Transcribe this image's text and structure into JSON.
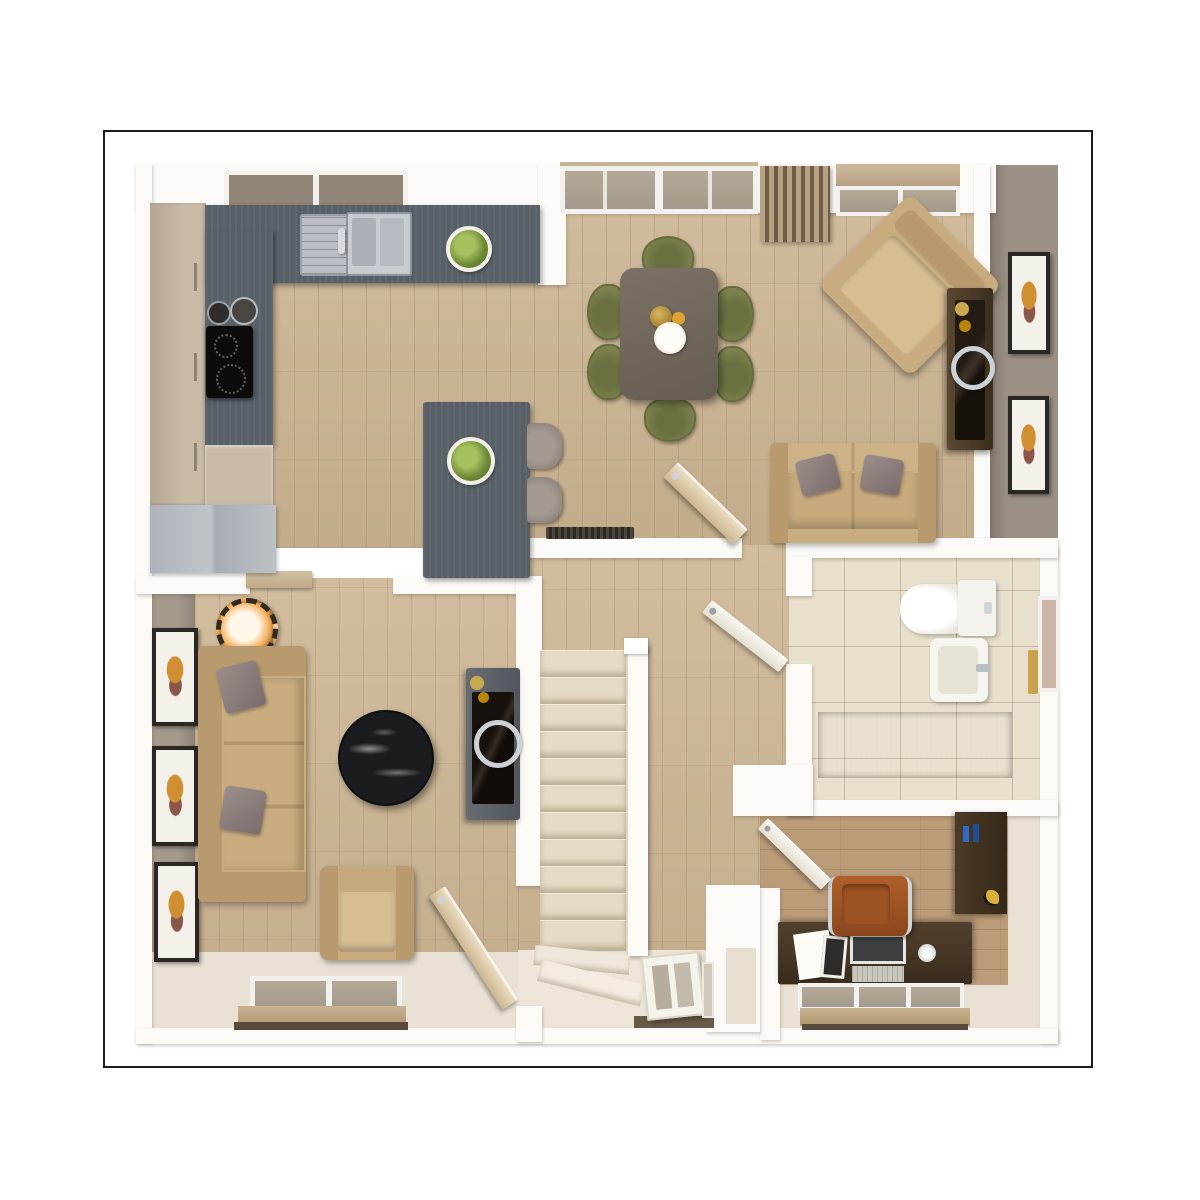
{
  "image_type": "3d-rendered-floorplan-top-view",
  "frame": {
    "border_color": "#1c1c1c",
    "background": "#ffffff"
  },
  "theme": {
    "wood": "#ccb593",
    "woodstudy": "#bb9c79",
    "wall": "#fbfaf7",
    "taupe": "#9c9184",
    "cream": "#e9e1d3",
    "counter": "#585f66",
    "tile": "#e8e0cd",
    "bathdark": "#5e6064",
    "carpet": "#e6dac4",
    "sofatan": "#c8ac80",
    "olive": "#7c814e",
    "tablebrown": "#6f675b",
    "darkwood": "#4a3a28",
    "tvblack": "#18130f",
    "pillow": "#8b7c7a",
    "art": "#d08f33",
    "blind": "#c0ab8e",
    "glass": "#a49a8c"
  },
  "rooms": {
    "kitchen": {
      "label": "Kitchen",
      "items": [
        "L-shaped slate worktop",
        "stainless sink with drainer",
        "induction hob with two pans",
        "tall cabinets",
        "grey appliance unit",
        "island table with plant",
        "two grey stools",
        "window over worktop"
      ]
    },
    "dining": {
      "label": "Dining area",
      "items": [
        "dark wood table",
        "six olive chairs",
        "vase, fruit and platter",
        "french doors",
        "slatted radiator panel",
        "window with tan pelmet"
      ]
    },
    "family": {
      "label": "Family area",
      "items": [
        "tan armchair at 45 degrees",
        "tan loveseat with two pillows",
        "dark media sideboard with silver ring",
        "wall radiator",
        "two framed pictures on right wall"
      ]
    },
    "lounge": {
      "label": "Lounge",
      "items": [
        "tan three-seat sofa with two pillows",
        "round black marble coffee table",
        "dark media unit with silver ring",
        "armchair",
        "table lamp on console",
        "three framed pictures on left wall",
        "window with tan blind"
      ]
    },
    "hall": {
      "label": "Hall",
      "items": [
        "straight staircase",
        "white banister",
        "winder steps",
        "front door with glazing",
        "storage nook"
      ]
    },
    "bathroom": {
      "label": "Bathroom",
      "items": [
        "toilet",
        "pedestal basin",
        "dark panel bath",
        "side window with blind",
        "door to hall"
      ]
    },
    "study": {
      "label": "Study",
      "items": [
        "dark wood desk",
        "open laptop",
        "papers and tablet",
        "cognac office chair",
        "dark bookcase",
        "window with tan blind",
        "door to hall"
      ]
    }
  },
  "counts": {
    "stair_treads": 11,
    "winder_steps": 2,
    "dining_chairs": 6,
    "island_stools": 2,
    "pictures_left_wall": 3,
    "pictures_right_wall": 2,
    "sofa_pillows": 4
  }
}
